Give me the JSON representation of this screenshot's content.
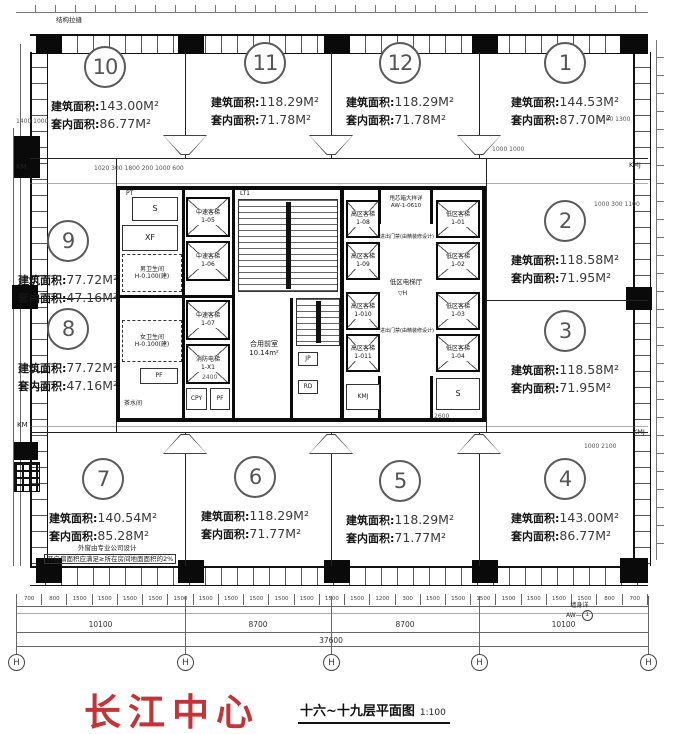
{
  "brand": {
    "name": "长江中心",
    "color": "#c23438"
  },
  "drawing_title": {
    "name": "十六~十九层平面图",
    "scale": "1:100"
  },
  "units": [
    {
      "no": "10",
      "fa_label": "建筑面积:",
      "fa": "143.00M²",
      "ia_label": "套内面积:",
      "ia": "86.77M²"
    },
    {
      "no": "11",
      "fa_label": "建筑面积:",
      "fa": "118.29M²",
      "ia_label": "套内面积:",
      "ia": "71.78M²"
    },
    {
      "no": "12",
      "fa_label": "建筑面积:",
      "fa": "118.29M²",
      "ia_label": "套内面积:",
      "ia": "71.78M²"
    },
    {
      "no": "1",
      "fa_label": "建筑面积:",
      "fa": "144.53M²",
      "ia_label": "套内面积:",
      "ia": "87.70M²"
    },
    {
      "no": "9",
      "fa_label": "建筑面积:",
      "fa": "77.72M²",
      "ia_label": "套内面积:",
      "ia": "47.16M²"
    },
    {
      "no": "8",
      "fa_label": "建筑面积:",
      "fa": "77.72M²",
      "ia_label": "套内面积:",
      "ia": "47.16M²"
    },
    {
      "no": "2",
      "fa_label": "建筑面积:",
      "fa": "118.58M²",
      "ia_label": "套内面积:",
      "ia": "71.95M²"
    },
    {
      "no": "3",
      "fa_label": "建筑面积:",
      "fa": "118.58M²",
      "ia_label": "套内面积:",
      "ia": "71.95M²"
    },
    {
      "no": "7",
      "fa_label": "建筑面积:",
      "fa": "140.54M²",
      "ia_label": "套内面积:",
      "ia": "85.28M²"
    },
    {
      "no": "6",
      "fa_label": "建筑面积:",
      "fa": "118.29M²",
      "ia_label": "套内面积:",
      "ia": "71.77M²"
    },
    {
      "no": "5",
      "fa_label": "建筑面积:",
      "fa": "118.29M²",
      "ia_label": "套内面积:",
      "ia": "71.77M²"
    },
    {
      "no": "4",
      "fa_label": "建筑面积:",
      "fa": "143.00M²",
      "ia_label": "套内面积:",
      "ia": "86.77M²"
    }
  ],
  "core": {
    "stair_label": "LT1",
    "front_room": "合用前室",
    "front_room_area": "10.14m²",
    "lobby": "低区电梯厅",
    "lobby_mark": "H",
    "box_note_1": "甩芯箱大样详",
    "box_note_2": "AW-1-0610",
    "access_note": "进出门禁(由精装修设计)",
    "rooms": {
      "pt": "PT",
      "s": "S",
      "xf": "XF",
      "male_wc": "男卫生间",
      "male_level": "H-0.100(建)",
      "female_wc": "女卫生间",
      "female_level": "H-0.100(建)",
      "pf": "PF",
      "tea": "茶水间",
      "cpy": "CPY",
      "pf2": "PF",
      "kmj": "KMJ",
      "s2": "S",
      "jp": "JP",
      "rd": "RD"
    },
    "elevators": [
      {
        "name": "中速客梯",
        "code": "1-05"
      },
      {
        "name": "中速客梯",
        "code": "1-06"
      },
      {
        "name": "中速客梯",
        "code": "1-07"
      },
      {
        "name": "消防电梯",
        "code": "1-X1"
      },
      {
        "name": "高区客梯",
        "code": "1-08"
      },
      {
        "name": "高区客梯",
        "code": "1-09"
      },
      {
        "name": "高区客梯",
        "code": "1-010"
      },
      {
        "name": "高区客梯",
        "code": "1-011"
      },
      {
        "name": "低区客梯",
        "code": "1-01"
      },
      {
        "name": "低区客梯",
        "code": "1-02"
      },
      {
        "name": "低区客梯",
        "code": "1-03"
      },
      {
        "name": "低区客梯",
        "code": "1-04"
      }
    ]
  },
  "edge": {
    "km_top": "KM",
    "km_mid": "KM",
    "kmj_right": "KMJ",
    "kmj_bottom": "KMJ"
  },
  "notes": {
    "top_left": "结构拉缝",
    "window_1": "外窗由专业公司设计",
    "window_2": "开启扇面积应满足≥所在房间地面面积的2%",
    "wall_detail_label": "墙身详",
    "wall_detail_ref": "AW—",
    "wall_detail_bubble": "1"
  },
  "dims": {
    "small_row": [
      "700",
      "800",
      "1500",
      "1500",
      "1500",
      "1500",
      "1500",
      "1500",
      "1500",
      "1500",
      "1500",
      "1500",
      "1500",
      "1500",
      "1200",
      "300",
      "1500",
      "1500",
      "1500",
      "1500",
      "1500",
      "1500",
      "1500",
      "800",
      "700"
    ],
    "major": [
      "10100",
      "8700",
      "8700",
      "10100"
    ],
    "total": "37600",
    "interior": [
      "1400  1000",
      "1020 300 1800 200 1000 600",
      "1000  1000",
      "1100  1300",
      "1000 300 1100",
      "2400",
      "2600",
      "1000  2100"
    ],
    "axis_bubbles": [
      "H",
      "H",
      "H",
      "H",
      "H"
    ]
  }
}
